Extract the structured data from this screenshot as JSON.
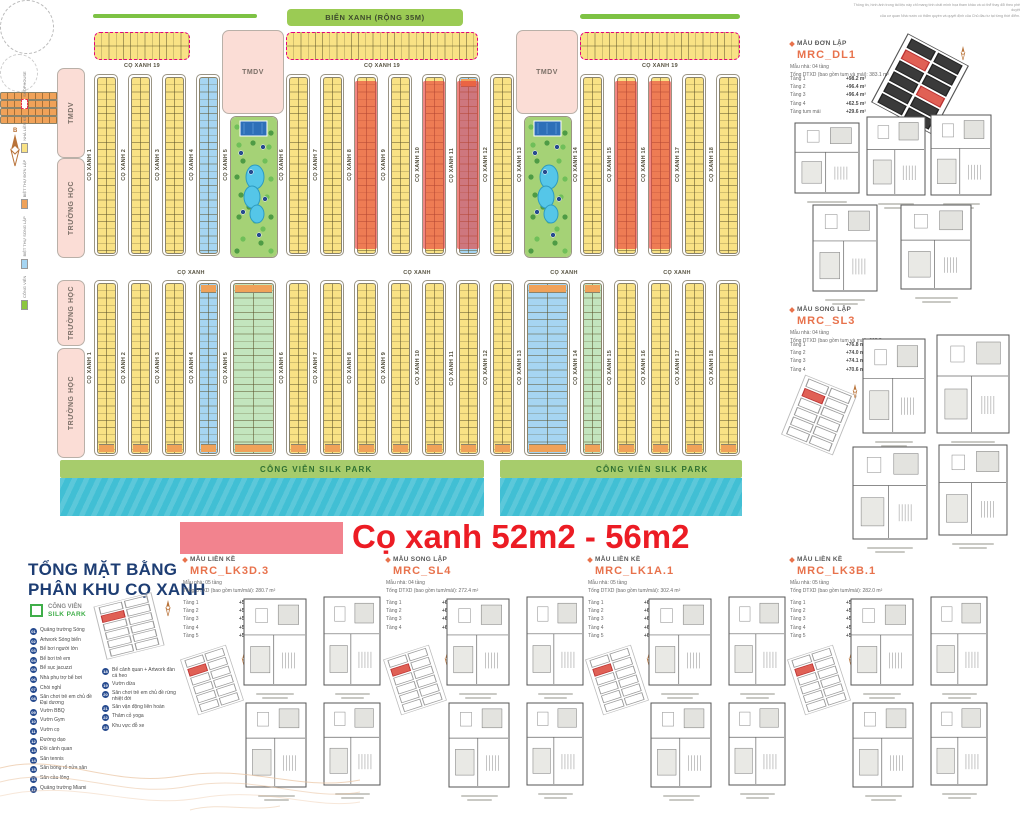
{
  "disclaimer": {
    "line1": "Thông tin, hình ảnh trong tài liệu này chỉ mang tính chất minh họa tham khảo và có thể thay đổi theo phê duyệt",
    "line2": "của cơ quan Nhà nước có thẩm quyền và quyết định của Chủ đầu tư tại từng thời điểm."
  },
  "map": {
    "beach_label": "BIỂN XANH (RỘNG 35M)",
    "row19_label": "CỌ XANH 19",
    "tmdv_label": "TMDV",
    "school_label": "TRƯỜNG HỌC",
    "co_xanh_label": "CỌ XANH",
    "park_label": "CÔNG VIÊN SILK PARK",
    "strip_labels": [
      "CỌ XANH 1",
      "CỌ XANH 2",
      "CỌ XANH 3",
      "CỌ XANH 4",
      "CỌ XANH 5",
      "CỌ XANH 6",
      "CỌ XANH 7",
      "CỌ XANH 8",
      "CỌ XANH 9",
      "CỌ XANH 10",
      "CỌ XANH 11",
      "CỌ XANH 12",
      "CỌ XANH 13",
      "CỌ XANH 14",
      "CỌ XANH 15",
      "CỌ XANH 16",
      "CỌ XANH 17",
      "CỌ XANH 18"
    ],
    "left_column_top": [
      "TMDV",
      "TRƯỜNG HỌC"
    ],
    "left_column_bottom": [
      "TRƯỜNG HỌC",
      "TRƯỜNG HỌC"
    ],
    "top_parks": [
      5,
      13
    ],
    "top_red": [
      8,
      10,
      11,
      15,
      16
    ],
    "top_blue": [
      4,
      11
    ],
    "top_orange_top": [
      11
    ],
    "bottom_blue": [
      4,
      13
    ],
    "bottom_green": [
      5,
      14
    ],
    "bottom_orange_top": [
      4,
      5,
      13,
      14
    ],
    "header_band_groups": [
      [
        3,
        4
      ],
      [
        9,
        10
      ],
      [
        13,
        14
      ],
      [
        16,
        17
      ]
    ],
    "mini_legend": [
      {
        "color": "#8CC63E",
        "label": "CÔNG VIÊN"
      },
      {
        "color": "#A6D5F2",
        "label": "BIỆT THỰ SONG LẬP"
      },
      {
        "color": "#F0A259",
        "label": "BIỆT THỰ ĐƠN LẬP"
      },
      {
        "color": "#F9E285",
        "label": "NHÀ LIỀN KỀ"
      },
      {
        "color": "dash",
        "label": "SHOPHOUSE"
      }
    ],
    "colors": {
      "yellow": "#F9E285",
      "blue": "#A6D5F2",
      "green": "#C3E5BE",
      "orange": "#F0A259"
    }
  },
  "banner": {
    "text": "Cọ xanh 52m2 - 56m2"
  },
  "legend": {
    "title1": "TỔNG MẶT BẰNG",
    "title2": "PHÂN KHU CỌ XANH",
    "park_swatch_line1": "CÔNG VIÊN",
    "park_swatch_line2": "SILK PARK",
    "items_left": [
      {
        "num": "01",
        "label": "Quảng trường Sóng"
      },
      {
        "num": "02",
        "label": "Artwork Sóng biển"
      },
      {
        "num": "03",
        "label": "Bể bơi người lớn"
      },
      {
        "num": "04",
        "label": "Bể bơi trẻ em"
      },
      {
        "num": "05",
        "label": "Bể sục jacuzzi"
      },
      {
        "num": "06",
        "label": "Nhà phụ trợ bể bơi"
      },
      {
        "num": "07",
        "label": "Chòi nghỉ"
      },
      {
        "num": "08",
        "label": "Sân chơi trẻ em chủ đề Đại dương"
      },
      {
        "num": "09",
        "label": "Vườn BBQ"
      },
      {
        "num": "10",
        "label": "Vườn Gym"
      },
      {
        "num": "11",
        "label": "Vườn cọ"
      },
      {
        "num": "12",
        "label": "Đường dạo"
      },
      {
        "num": "13",
        "label": "Đồi cảnh quan"
      },
      {
        "num": "14",
        "label": "Sân tennis"
      },
      {
        "num": "15",
        "label": "Sân bóng rổ nửa sân"
      },
      {
        "num": "16",
        "label": "Sân cầu lông"
      },
      {
        "num": "17",
        "label": "Quảng trường Miami"
      }
    ],
    "items_right": [
      {
        "num": "18",
        "label": "Bể cảnh quan + Artwork đàn cá heo"
      },
      {
        "num": "19",
        "label": "Vườn dừa"
      },
      {
        "num": "20",
        "label": "Sân chơi trẻ em chủ đề rừng nhiệt đới"
      },
      {
        "num": "21",
        "label": "Sân vận động liên hoàn"
      },
      {
        "num": "22",
        "label": "Thảm cỏ yoga"
      },
      {
        "num": "23",
        "label": "Khu vực đỗ xe"
      }
    ]
  },
  "right_panels": [
    {
      "type_label": "MẪU ĐƠN LẬP",
      "code": "MRC_DL1",
      "spec1": "Mẫu nhà: 04 tầng",
      "spec2": "Tổng DTXD (bao gồm tum và mái): 383.1 m²",
      "floors": [
        {
          "name": "Tầng 1",
          "area": "+98.2 m²"
        },
        {
          "name": "Tầng 2",
          "area": "+96.4 m²"
        },
        {
          "name": "Tầng 3",
          "area": "+96.4 m²"
        },
        {
          "name": "Tầng 4",
          "area": "+62.5 m²"
        },
        {
          "name": "Tầng tum mái",
          "area": "+29.6 m²"
        }
      ]
    },
    {
      "type_label": "MẪU SONG LẬP",
      "code": "MRC_SL3",
      "spec1": "Mẫu nhà: 04 tầng",
      "spec2": "Tổng DTXD (bao gồm tum và mái): 295.5 m²",
      "floors": [
        {
          "name": "Tầng 1",
          "area": "+76.8 m²"
        },
        {
          "name": "Tầng 2",
          "area": "+74.0 m²"
        },
        {
          "name": "Tầng 3",
          "area": "+74.1 m²"
        },
        {
          "name": "Tầng 4",
          "area": "+70.6 m²"
        }
      ]
    }
  ],
  "bottom_cards": [
    {
      "type_label": "MẪU LIỀN KỀ",
      "code": "MRC_LK3D.3",
      "spec1": "Mẫu nhà: 05 tầng",
      "spec2": "Tổng DTXD (bao gồm tum/mái): 280.7 m²",
      "floors": [
        {
          "name": "Tầng 1",
          "area": "+55.9 m²"
        },
        {
          "name": "Tầng 2",
          "area": "+56.2 m²"
        },
        {
          "name": "Tầng 3",
          "area": "+56.2 m²"
        },
        {
          "name": "Tầng 4",
          "area": "+56.2 m²"
        },
        {
          "name": "Tầng 5",
          "area": "+56.2 m²"
        }
      ]
    },
    {
      "type_label": "MẪU SONG LẬP",
      "code": "MRC_SL4",
      "spec1": "Mẫu nhà: 04 tầng",
      "spec2": "Tổng DTXD (bao gồm tum/mái): 272.4 m²",
      "floors": [
        {
          "name": "Tầng 1",
          "area": "+69.4 m²"
        },
        {
          "name": "Tầng 2",
          "area": "+68.2 m²"
        },
        {
          "name": "Tầng 3",
          "area": "+67.6 m²"
        },
        {
          "name": "Tầng 4",
          "area": "+67.2 m²"
        }
      ]
    },
    {
      "type_label": "MẪU LIỀN KỀ",
      "code": "MRC_LK1A.1",
      "spec1": "Mẫu nhà: 05 tầng",
      "spec2": "Tổng DTXD (bao gồm tum/mái): 302.4 m²",
      "floors": [
        {
          "name": "Tầng 1",
          "area": "+60.2 m²"
        },
        {
          "name": "Tầng 2",
          "area": "+61.0 m²"
        },
        {
          "name": "Tầng 3",
          "area": "+60.6 m²"
        },
        {
          "name": "Tầng 4",
          "area": "+60.2 m²"
        },
        {
          "name": "Tầng 5",
          "area": "+60.4 m²"
        }
      ]
    },
    {
      "type_label": "MẪU LIỀN KỀ",
      "code": "MRC_LK3B.1",
      "spec1": "Mẫu nhà: 05 tầng",
      "spec2": "Tổng DTXD (bao gồm tum/mái): 282.0 m²",
      "floors": [
        {
          "name": "Tầng 1",
          "area": "+56.4 m²"
        },
        {
          "name": "Tầng 2",
          "area": "+56.4 m²"
        },
        {
          "name": "Tầng 3",
          "area": "+56.4 m²"
        },
        {
          "name": "Tầng 4",
          "area": "+56.4 m²"
        },
        {
          "name": "Tầng 5",
          "area": "+56.4 m²"
        }
      ]
    }
  ]
}
